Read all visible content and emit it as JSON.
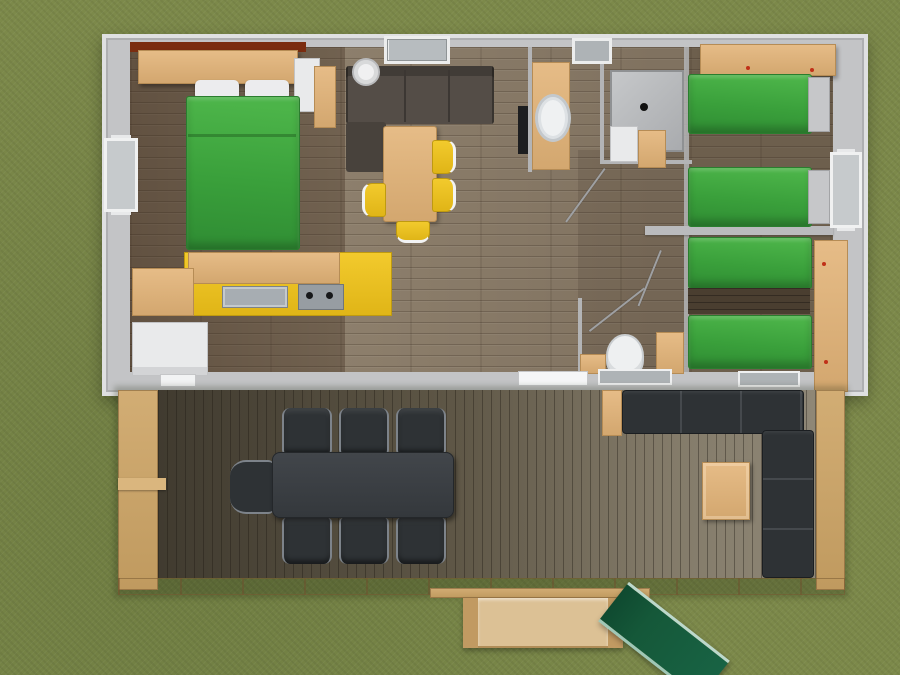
{
  "scene": {
    "description": "Top-down 3D rendering of a mobile home floor plan with a wooden terrace, set on grass",
    "view": "aerial top-down 3D render",
    "background": "grass lawn",
    "text_visible": "none"
  },
  "palette": {
    "grass": "#7c894a",
    "wall_gray": "#c3c4c6",
    "interior_floor": "#8d7f6c",
    "dark_floor": "#4a3e30",
    "bed_green": "#3aa03b",
    "wood_tan": "#dcb27d",
    "kitchen_yellow": "#e8bf1d",
    "sofa_brown": "#544d47",
    "appliance_white": "#e9eaeb",
    "deck_wood": "#6f6653",
    "railing_tan": "#c9a46b",
    "outdoor_black": "#2e3235",
    "slide_green": "#155839",
    "roof_trim_red": "#7b2d10"
  },
  "rooms": [
    {
      "name": "master-bedroom",
      "features": [
        "double-bed-green",
        "overhead-shelf",
        "wardrobe",
        "dresser"
      ]
    },
    {
      "name": "kitchen",
      "features": [
        "yellow-counter",
        "sink",
        "cooktop",
        "fridge",
        "side-counter"
      ]
    },
    {
      "name": "living-dining",
      "features": [
        "brown-sofa",
        "chaise",
        "dining-table",
        "4-yellow-chairs",
        "round-lamp"
      ]
    },
    {
      "name": "bathroom",
      "features": [
        "vanity-washbasin",
        "shower-cabin",
        "skylight",
        "radiator"
      ]
    },
    {
      "name": "wc",
      "features": [
        "toilet",
        "cabinets"
      ]
    },
    {
      "name": "kids-bedroom-1",
      "features": [
        "single-bed-green",
        "single-bed-green",
        "overhead-shelf"
      ]
    },
    {
      "name": "kids-bedroom-2",
      "features": [
        "single-bed-green",
        "single-bed-green",
        "wall-desk"
      ]
    },
    {
      "name": "terrace",
      "features": [
        "black-dining-table",
        "7-black-chairs",
        "l-shaped-lounge-sofa",
        "coffee-table",
        "side-table",
        "railing",
        "steps",
        "green-slide"
      ]
    }
  ],
  "counts": {
    "green_beds": 5,
    "yellow_chairs": 4,
    "deck_chairs": 7,
    "windows_side_walls": 2,
    "windows_top_wall": 2
  }
}
